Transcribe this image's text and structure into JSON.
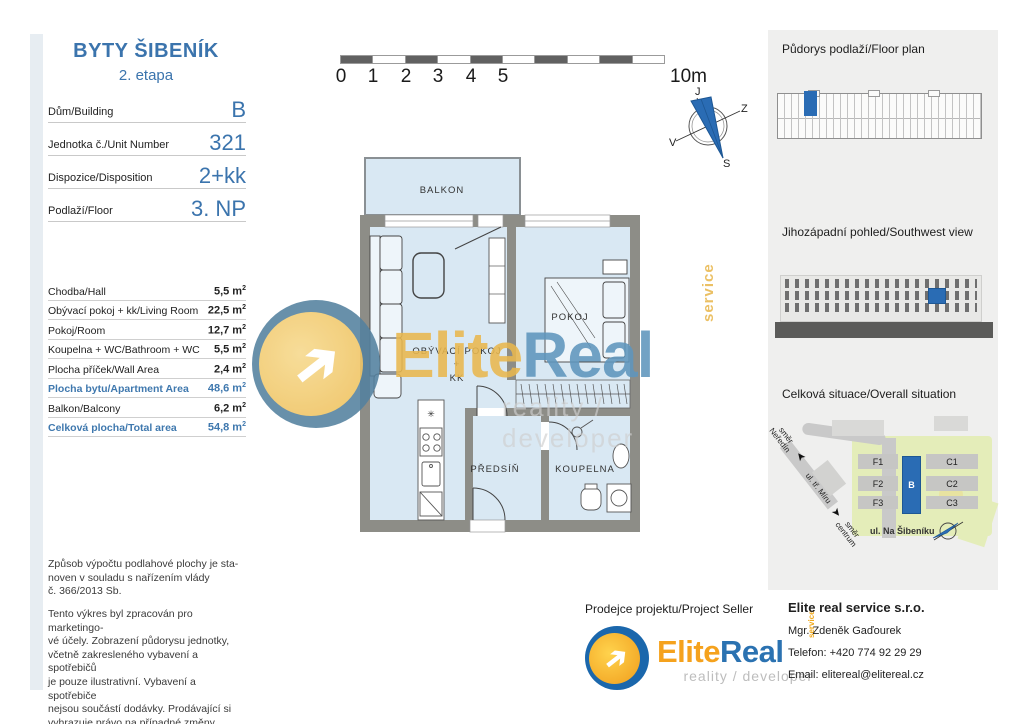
{
  "colors": {
    "accent_blue": "#3b74ad",
    "highlight_blue": "#2a6cb4",
    "wall_gray": "#8d8d87",
    "floor_blue": "#d9e8f3",
    "logo_orange": "#f5a21d",
    "logo_blue": "#1b67ac",
    "map_green": "#e4edb9"
  },
  "left_panel": {
    "title": "BYTY ŠIBENÍK",
    "subtitle": "2. etapa",
    "info_rows": [
      {
        "label": "Dům/Building",
        "value": "B"
      },
      {
        "label": "Jednotka č./Unit Number",
        "value": "321"
      },
      {
        "label": "Dispozice/Disposition",
        "value": "2+kk"
      },
      {
        "label": "Podlaží/Floor",
        "value": "3. NP"
      }
    ],
    "area_rows": [
      {
        "label": "Chodba/Hall",
        "value": "5,5 m",
        "sup": "2"
      },
      {
        "label": "Obývací pokoj + kk/Living Room",
        "value": "22,5 m",
        "sup": "2"
      },
      {
        "label": "Pokoj/Room",
        "value": "12,7 m",
        "sup": "2"
      },
      {
        "label": "Koupelna + WC/Bathroom + WC",
        "value": "5,5 m",
        "sup": "2"
      },
      {
        "label": "Plocha příček/Wall Area",
        "value": "2,4 m",
        "sup": "2"
      },
      {
        "label": "Plocha bytu/Apartment Area",
        "value": "48,6 m",
        "sup": "2"
      },
      {
        "label": "Balkon/Balcony",
        "value": "6,2 m",
        "sup": "2"
      },
      {
        "label": "Celková plocha/Total area",
        "value": "54,8 m",
        "sup": "2"
      }
    ],
    "disclaimer1": [
      "Způsob výpočtu podlahové plochy je sta-",
      "noven v souladu s nařízením vlády",
      "č. 366/2013 Sb."
    ],
    "disclaimer2": [
      "Tento výkres byl zpracován pro marketingo-",
      "vé účely. Zobrazení půdorysu jednotky,",
      "včetně zakresleného vybavení a spotřebičů",
      "je pouze ilustrativní. Vybavení a spotřebiče",
      "nejsou součástí dodávky. Prodávající si",
      "vyhrazuje právo na případné změny."
    ]
  },
  "scalebar": {
    "ticks": [
      "0",
      "1",
      "2",
      "3",
      "4",
      "5"
    ],
    "end_label": "10m"
  },
  "compass": {
    "top": "J",
    "right": "Z",
    "left": "V",
    "bottom": "S"
  },
  "floorplan": {
    "balkon": "BALKON",
    "pokoj": "POKOJ",
    "obyvaci": "OBÝVACÍ POKOJ",
    "plus": "+",
    "kk": "KK",
    "predsin": "PŘEDSÍŇ",
    "koupelna": "KOUPELNA"
  },
  "watermark": {
    "elite": "Elite",
    "real": "Real",
    "service": "service",
    "tagline": "reality / developer",
    "arrow": "➔"
  },
  "right_panel": {
    "floorplan_title": "Půdorys podlaží/Floor plan",
    "elevation_title": "Jihozápadní pohled/Southwest view",
    "situation_title": "Celková situace/Overall situation",
    "map": {
      "f1": "F1",
      "f2": "F2",
      "f3": "F3",
      "b": "B",
      "c1": "C1",
      "c2": "C2",
      "c3": "C3",
      "street": "ul. Na Šibeníku",
      "dir_top_1": "směr",
      "dir_top_2": "Neředín",
      "road_label": "ul. tř. Míru",
      "dir_bottom_1": "směr",
      "dir_bottom_2": "centrum",
      "arrow_up": "➤",
      "arrow_down": "➤"
    }
  },
  "seller": {
    "title": "Prodejce projektu/Project Seller",
    "elite": "Elite",
    "real": "Real",
    "service": "service",
    "tagline": "reality / developer",
    "arrow": "➔"
  },
  "contact": {
    "company": "Elite real service s.r.o.",
    "person": "Mgr. Zdeněk Gaďourek",
    "phone": "Telefon: +420 774 92 29 29",
    "email": "Email: elitereal@elitereal.cz"
  }
}
